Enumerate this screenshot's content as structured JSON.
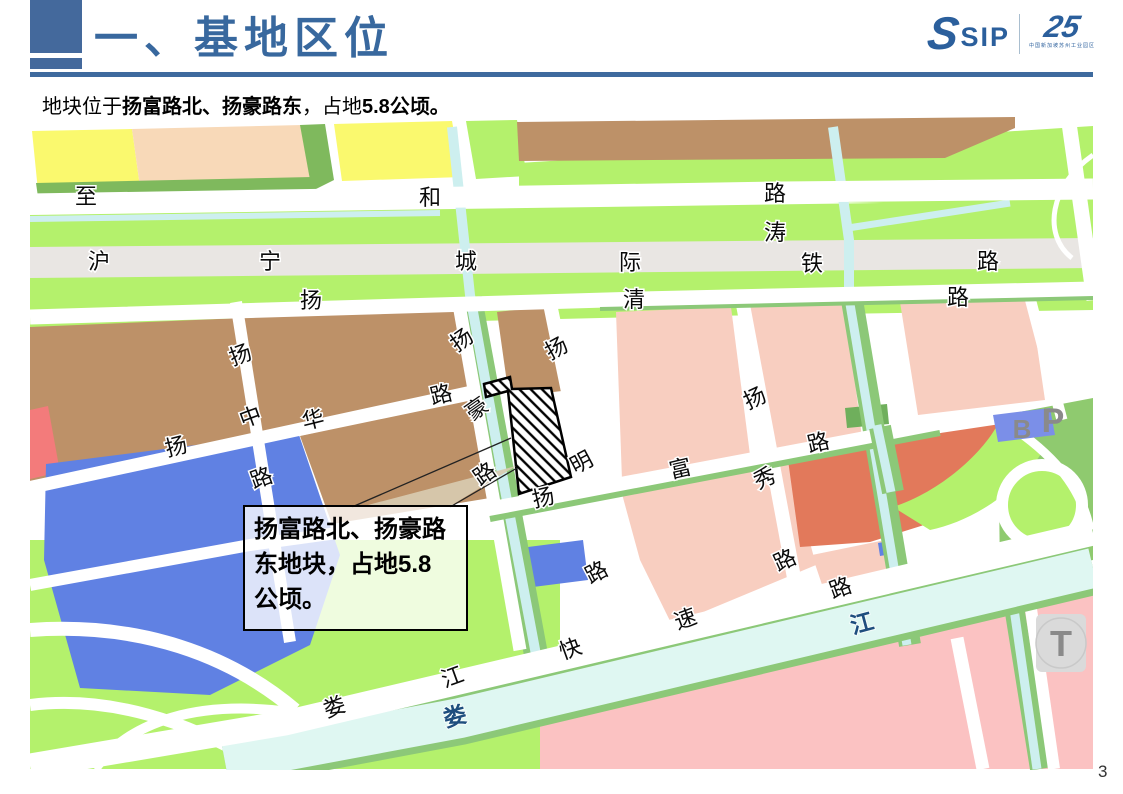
{
  "slide": {
    "page_number": "3"
  },
  "header": {
    "title": "一、基地区位",
    "logo": {
      "s_mark": "S",
      "sip": "SIP",
      "anniversary": "25",
      "fine_print": "中国新加坡苏州工业园区"
    }
  },
  "subtitle": {
    "prefix": "地块位于",
    "bold_roads": "扬富路北、扬豪路东",
    "mid": "，占地",
    "bold_area": "5.8公顷。"
  },
  "callout": {
    "lines": [
      "扬富路北、扬豪路",
      "东地块，占地5.8",
      "公顷。"
    ]
  },
  "map": {
    "labels": [
      {
        "char": "至",
        "road": "至和路",
        "x": 86,
        "y": 204,
        "rot": 0,
        "style": "road"
      },
      {
        "char": "和",
        "road": "至和路",
        "x": 430,
        "y": 205,
        "rot": 0,
        "style": "road"
      },
      {
        "char": "路",
        "road": "至和路",
        "x": 775,
        "y": 201,
        "rot": 0,
        "style": "road"
      },
      {
        "char": "涛",
        "road": "涛",
        "x": 775,
        "y": 240,
        "rot": 0,
        "style": "road"
      },
      {
        "char": "沪",
        "road": "沪宁城际铁路",
        "x": 99,
        "y": 269,
        "rot": 0,
        "style": "road"
      },
      {
        "char": "宁",
        "road": "沪宁城际铁路",
        "x": 270,
        "y": 269,
        "rot": 0,
        "style": "road"
      },
      {
        "char": "城",
        "road": "沪宁城际铁路",
        "x": 466,
        "y": 269,
        "rot": 0,
        "style": "road"
      },
      {
        "char": "际",
        "road": "沪宁城际铁路",
        "x": 630,
        "y": 270,
        "rot": 0,
        "style": "road"
      },
      {
        "char": "铁",
        "road": "沪宁城际铁路",
        "x": 812,
        "y": 271,
        "rot": 0,
        "style": "road"
      },
      {
        "char": "路",
        "road": "沪宁城际铁路",
        "x": 988,
        "y": 269,
        "rot": 0,
        "style": "road"
      },
      {
        "char": "扬",
        "road": "扬清路",
        "x": 311,
        "y": 308,
        "rot": 0,
        "style": "road"
      },
      {
        "char": "清",
        "road": "扬清路",
        "x": 634,
        "y": 307,
        "rot": 0,
        "style": "road"
      },
      {
        "char": "路",
        "road": "扬清路",
        "x": 958,
        "y": 305,
        "rot": 0,
        "style": "road"
      },
      {
        "char": "扬",
        "road": "扬中路",
        "x": 243,
        "y": 362,
        "rot": -20,
        "style": "road"
      },
      {
        "char": "中",
        "road": "扬中路",
        "x": 253,
        "y": 424,
        "rot": -20,
        "style": "road"
      },
      {
        "char": "路",
        "road": "扬中路",
        "x": 264,
        "y": 485,
        "rot": -20,
        "style": "road"
      },
      {
        "char": "扬",
        "road": "扬华路",
        "x": 178,
        "y": 454,
        "rot": -14,
        "style": "road"
      },
      {
        "char": "华",
        "road": "扬华路",
        "x": 315,
        "y": 427,
        "rot": -14,
        "style": "road"
      },
      {
        "char": "路",
        "road": "扬华路",
        "x": 443,
        "y": 402,
        "rot": -14,
        "style": "road"
      },
      {
        "char": "扬",
        "road": "扬豪路",
        "x": 466,
        "y": 346,
        "rot": -35,
        "style": "road"
      },
      {
        "char": "豪",
        "road": "扬豪路",
        "x": 481,
        "y": 415,
        "rot": -35,
        "style": "road"
      },
      {
        "char": "路",
        "road": "扬豪路",
        "x": 489,
        "y": 480,
        "rot": -35,
        "style": "road"
      },
      {
        "char": "扬",
        "road": "扬明路",
        "x": 560,
        "y": 355,
        "rot": -28,
        "style": "road"
      },
      {
        "char": "明",
        "road": "扬明路",
        "x": 585,
        "y": 469,
        "rot": -28,
        "style": "road"
      },
      {
        "char": "路",
        "road": "扬明路",
        "x": 600,
        "y": 579,
        "rot": -28,
        "style": "road"
      },
      {
        "char": "扬",
        "road": "扬富路",
        "x": 545,
        "y": 505,
        "rot": -13,
        "style": "road"
      },
      {
        "char": "富",
        "road": "扬富路",
        "x": 682,
        "y": 476,
        "rot": -13,
        "style": "road"
      },
      {
        "char": "路",
        "road": "扬富路",
        "x": 820,
        "y": 450,
        "rot": -13,
        "style": "road"
      },
      {
        "char": "扬",
        "road": "扬秀路",
        "x": 758,
        "y": 405,
        "rot": -25,
        "style": "road"
      },
      {
        "char": "秀",
        "road": "扬秀路",
        "x": 768,
        "y": 485,
        "rot": -25,
        "style": "road"
      },
      {
        "char": "路",
        "road": "扬秀路",
        "x": 788,
        "y": 567,
        "rot": -25,
        "style": "road"
      },
      {
        "char": "娄",
        "road": "娄江快速路",
        "x": 337,
        "y": 714,
        "rot": -20,
        "style": "road"
      },
      {
        "char": "江",
        "road": "娄江快速路",
        "x": 455,
        "y": 684,
        "rot": -20,
        "style": "road"
      },
      {
        "char": "快",
        "road": "娄江快速路",
        "x": 573,
        "y": 656,
        "rot": -20,
        "style": "road"
      },
      {
        "char": "速",
        "road": "娄江快速路",
        "x": 688,
        "y": 626,
        "rot": -20,
        "style": "road"
      },
      {
        "char": "路",
        "road": "娄江快速路",
        "x": 843,
        "y": 595,
        "rot": -20,
        "style": "road"
      },
      {
        "char": "娄",
        "road": "娄江(河)",
        "x": 457,
        "y": 724,
        "rot": -15,
        "style": "river"
      },
      {
        "char": "江",
        "road": "娄江(河)",
        "x": 864,
        "y": 631,
        "rot": -15,
        "style": "river"
      }
    ],
    "markers": [
      {
        "label": "B",
        "x": 1022,
        "y": 438,
        "size": 26
      },
      {
        "label": "P",
        "x": 1053,
        "y": 432,
        "size": 34
      },
      {
        "label": "T",
        "x": 1061,
        "y": 656,
        "size": 36
      }
    ],
    "colors": {
      "yellow_parcel": "#FAF96E",
      "peach_parcel": "#F8D9B8",
      "brown_parcel": "#BD9168",
      "light_green": "#B4F16C",
      "mid_green": "#8FCA6F",
      "edge_green": "#7FB95D",
      "verge_green": "#8CC878",
      "pink_parcel": "#F8CEC0",
      "bottom_pink": "#FBC2C2",
      "red_parcel": "#F37B7B",
      "orange_parcel": "#E2795B",
      "blue_parcel": "#6081E3",
      "water": "#DFF7F2",
      "canal": "#CDEFEF",
      "railway_gray": "#E9E6E3",
      "station_gray": "#DADADA",
      "marker_gray": "#8A8A8A",
      "accent_blue": "#3E6A9E",
      "logo_blue": "#2B5F9C"
    }
  }
}
